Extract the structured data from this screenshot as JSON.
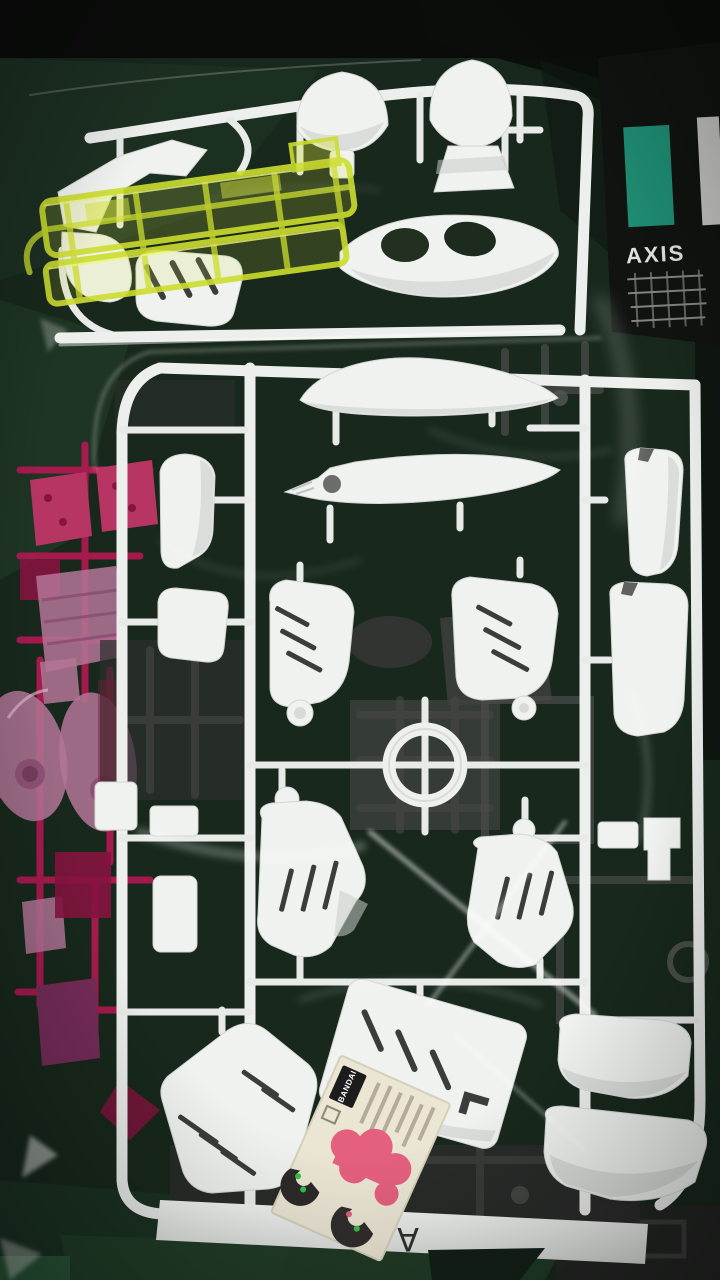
{
  "box_spine": {
    "label": "AXIS",
    "accent_color": "#1f8e74"
  },
  "runner": {
    "letter": "A",
    "plastic_color": "#f0f2f0"
  },
  "sticker": {
    "brand": "BANDAI",
    "base_color": "#ebe6d4",
    "mark_color": "#e4607e"
  },
  "palette": {
    "background_green": "#1a2b1f",
    "deep_shadow": "#0b0e0b",
    "white_plastic": "#f0f2f0",
    "clear_yellow_green": "#ccdd2e",
    "magenta_runner": "#b01a51",
    "clear_pink": "#c07ba1",
    "gray_plastic": "#3f413f"
  }
}
